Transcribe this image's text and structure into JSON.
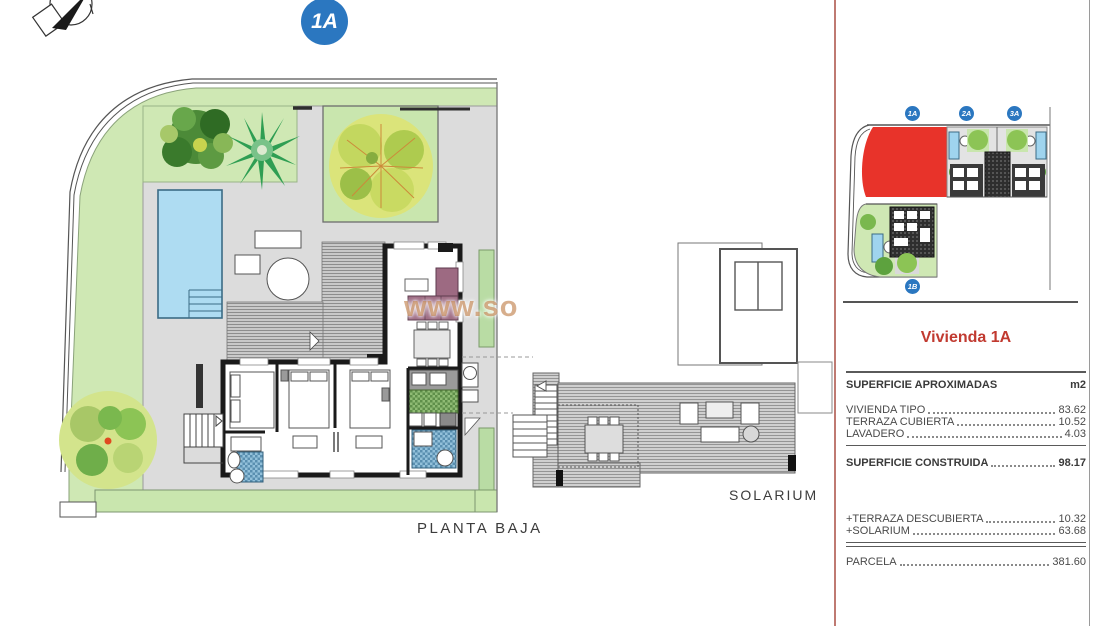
{
  "header": {
    "unit_badge": "1A"
  },
  "compass": {
    "icon": "north-compass"
  },
  "watermark": {
    "text": "www.so",
    "tail": "larium"
  },
  "floor_plan": {
    "label": "PLANTA BAJA"
  },
  "solarium_plan": {
    "label": "SOLARIUM"
  },
  "site_map": {
    "badges": [
      {
        "label": "1A"
      },
      {
        "label": "2A"
      },
      {
        "label": "3A"
      },
      {
        "label": "1B"
      }
    ],
    "highlighted_unit": "1A"
  },
  "panel": {
    "title": "Vivienda 1A",
    "header": {
      "label": "SUPERFICIE APROXIMADAS",
      "unit": "m2"
    },
    "rows": [
      {
        "label": "VIVIENDA TIPO",
        "value": "83.62"
      },
      {
        "label": "TERRAZA CUBIERTA",
        "value": "10.52"
      },
      {
        "label": "LAVADERO",
        "value": "4.03"
      }
    ],
    "total_row": {
      "label": "SUPERFICIE CONSTRUIDA",
      "value": "98.17"
    },
    "extra_rows": [
      {
        "label": "+TERRAZA DESCUBIERTA",
        "value": "10.32"
      },
      {
        "label": "+SOLARIUM",
        "value": "63.68"
      }
    ],
    "parcel_row": {
      "label": "PARCELA",
      "value": "381.60"
    }
  },
  "colors": {
    "highlight_red": "#e8332a",
    "badge_blue": "#2b77c0",
    "title_red": "#c13a30",
    "garden_green": "#cfe8b4",
    "pool_blue": "#aedcf2",
    "sofa_mauve": "#9d6a82",
    "deck_gray": "#c9c9c9",
    "divider_red": "#bf7a72",
    "watermark_orange": "rgba(191,125,70,0.62)"
  }
}
